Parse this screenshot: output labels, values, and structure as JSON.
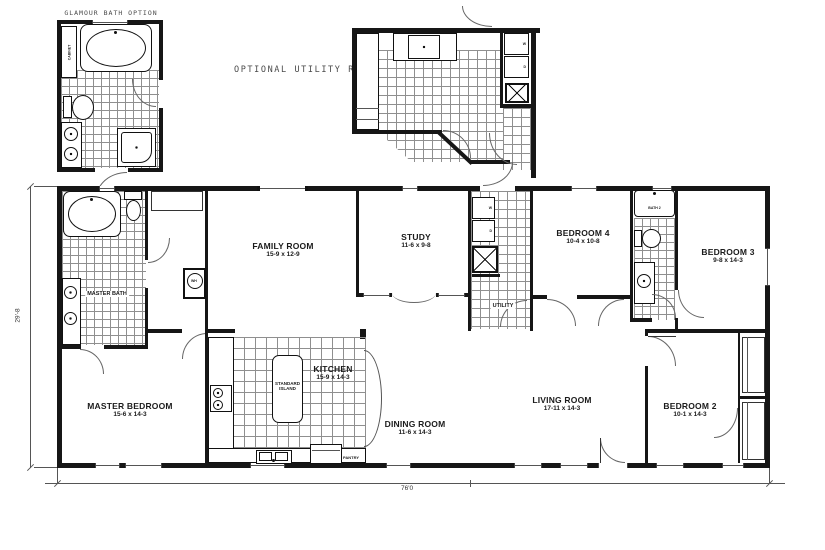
{
  "options": {
    "glamour_bath": {
      "title": "GLAMOUR BATH OPTION",
      "cabinet_label": "CABINET"
    },
    "optional_utility": {
      "title": "OPTIONAL UTILITY ROOM"
    }
  },
  "rooms": {
    "master_bath": {
      "name": "MASTER BATH"
    },
    "family_room": {
      "name": "FAMILY ROOM",
      "dims": "15-9 x 12-9"
    },
    "study": {
      "name": "STUDY",
      "dims": "11-6 x 9-8"
    },
    "utility": {
      "name": "UTILITY"
    },
    "bedroom4": {
      "name": "BEDROOM 4",
      "dims": "10-4 x 10-8"
    },
    "bath2": {
      "name": "BATH 2"
    },
    "bedroom3": {
      "name": "BEDROOM 3",
      "dims": "9-8 x 14-3"
    },
    "master_bedroom": {
      "name": "MASTER BEDROOM",
      "dims": "15-6 x 14-3"
    },
    "kitchen": {
      "name": "KITCHEN",
      "dims": "15-9 x 14-3"
    },
    "island": {
      "line1": "STANDARD",
      "line2": "ISLAND"
    },
    "pantry": {
      "name": "PANTRY"
    },
    "dining_room": {
      "name": "DINING ROOM",
      "dims": "11-6 x 14-3"
    },
    "living_room": {
      "name": "LIVING ROOM",
      "dims": "17-11 x 14-3"
    },
    "bedroom2": {
      "name": "BEDROOM 2",
      "dims": "10-1 x 14-3"
    }
  },
  "fixtures": {
    "water_heater": "WH",
    "washer": "W",
    "dryer": "D"
  },
  "dimensions": {
    "overall_width": "76'0",
    "overall_depth": "29'-8"
  },
  "colors": {
    "wall": "#161616",
    "tile_line": "#8f8f8f",
    "label": "#1b1b1b",
    "muted": "#4a4a4a"
  }
}
